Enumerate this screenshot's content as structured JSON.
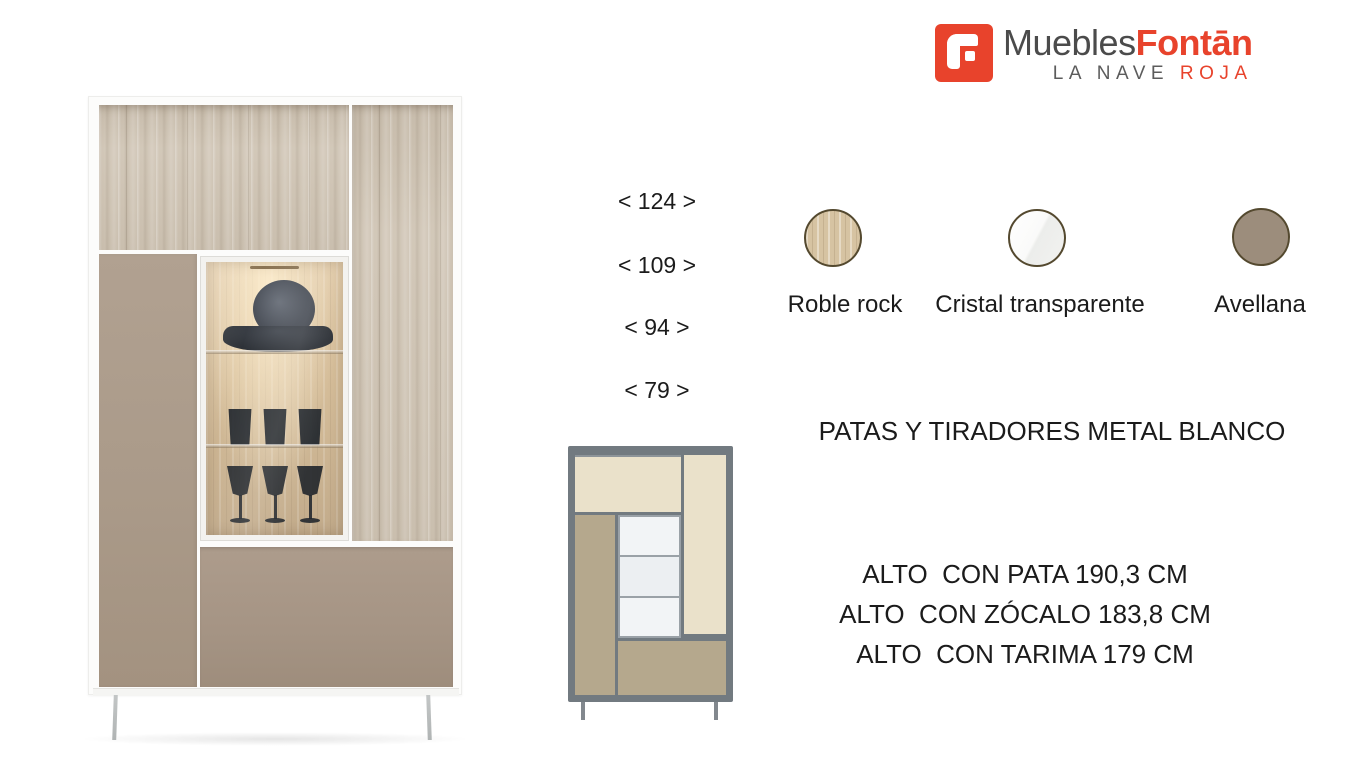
{
  "brand": {
    "name_primary": "Muebles",
    "name_accent": "Fontān",
    "tagline_primary": "LA NAVE ",
    "tagline_accent": "ROJA",
    "accent_color": "#e8432c",
    "text_color": "#4b4b4b",
    "icon": "fontan-f-icon"
  },
  "width_labels": [
    "< 124 >",
    "< 109 >",
    "< 94 >",
    "< 79 >"
  ],
  "finishes": {
    "items": [
      {
        "label": "Roble rock",
        "type": "wood-swatch",
        "color": "#d6c3a2"
      },
      {
        "label": "Cristal transparente",
        "type": "glass-swatch",
        "color": "#f4f4f2"
      },
      {
        "label": "Avellana",
        "type": "solid-swatch",
        "color": "#9c8d7c"
      }
    ],
    "border_color": "#54492f"
  },
  "hardware_note": "PATAS Y TIRADORES METAL BLANCO",
  "height_specs": [
    "ALTO  CON PATA 190,3 CM",
    "ALTO  CON ZÓCALO 183,8 CM",
    "ALTO  CON TARIMA 179 CM"
  ],
  "schematic_colors": {
    "frame": "#727a80",
    "oak": "#eae1ca",
    "hazel": "#b5a88d",
    "glass": "#f2f4f6"
  }
}
